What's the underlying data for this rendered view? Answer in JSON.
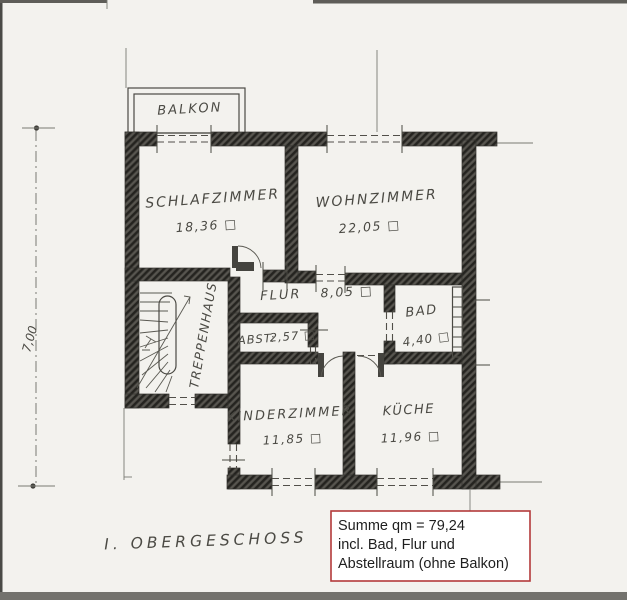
{
  "meta": {
    "floor_label": "I. OBERGESCHOSS",
    "drawing_type": "hand-drawn floor plan scan"
  },
  "dimension": {
    "value": "7,00"
  },
  "rooms": [
    {
      "name": "BALKON",
      "area": ""
    },
    {
      "name": "SCHLAFZIMMER",
      "area": "18,36 □"
    },
    {
      "name": "WOHNZIMMER",
      "area": "22,05 □"
    },
    {
      "name": "FLUR",
      "area": "8,05 □"
    },
    {
      "name": "BAD",
      "area": "4,40 □"
    },
    {
      "name": "ABST:",
      "area": "2,57 □"
    },
    {
      "name": "TREPPENHAUS",
      "area": ""
    },
    {
      "name": "KINDERZIMMER",
      "area": "11,85 □"
    },
    {
      "name": "KÜCHE",
      "area": "11,96 □"
    }
  ],
  "summary": {
    "line1": "Summe qm = 79,24",
    "line2": "incl. Bad, Flur und",
    "line3": "Abstellraum (ohne Balkon)"
  },
  "colors": {
    "paper": "#f3f2ee",
    "pencil": "#4b4a44",
    "wall": "#45443f",
    "summary_border": "#b33a3a"
  }
}
